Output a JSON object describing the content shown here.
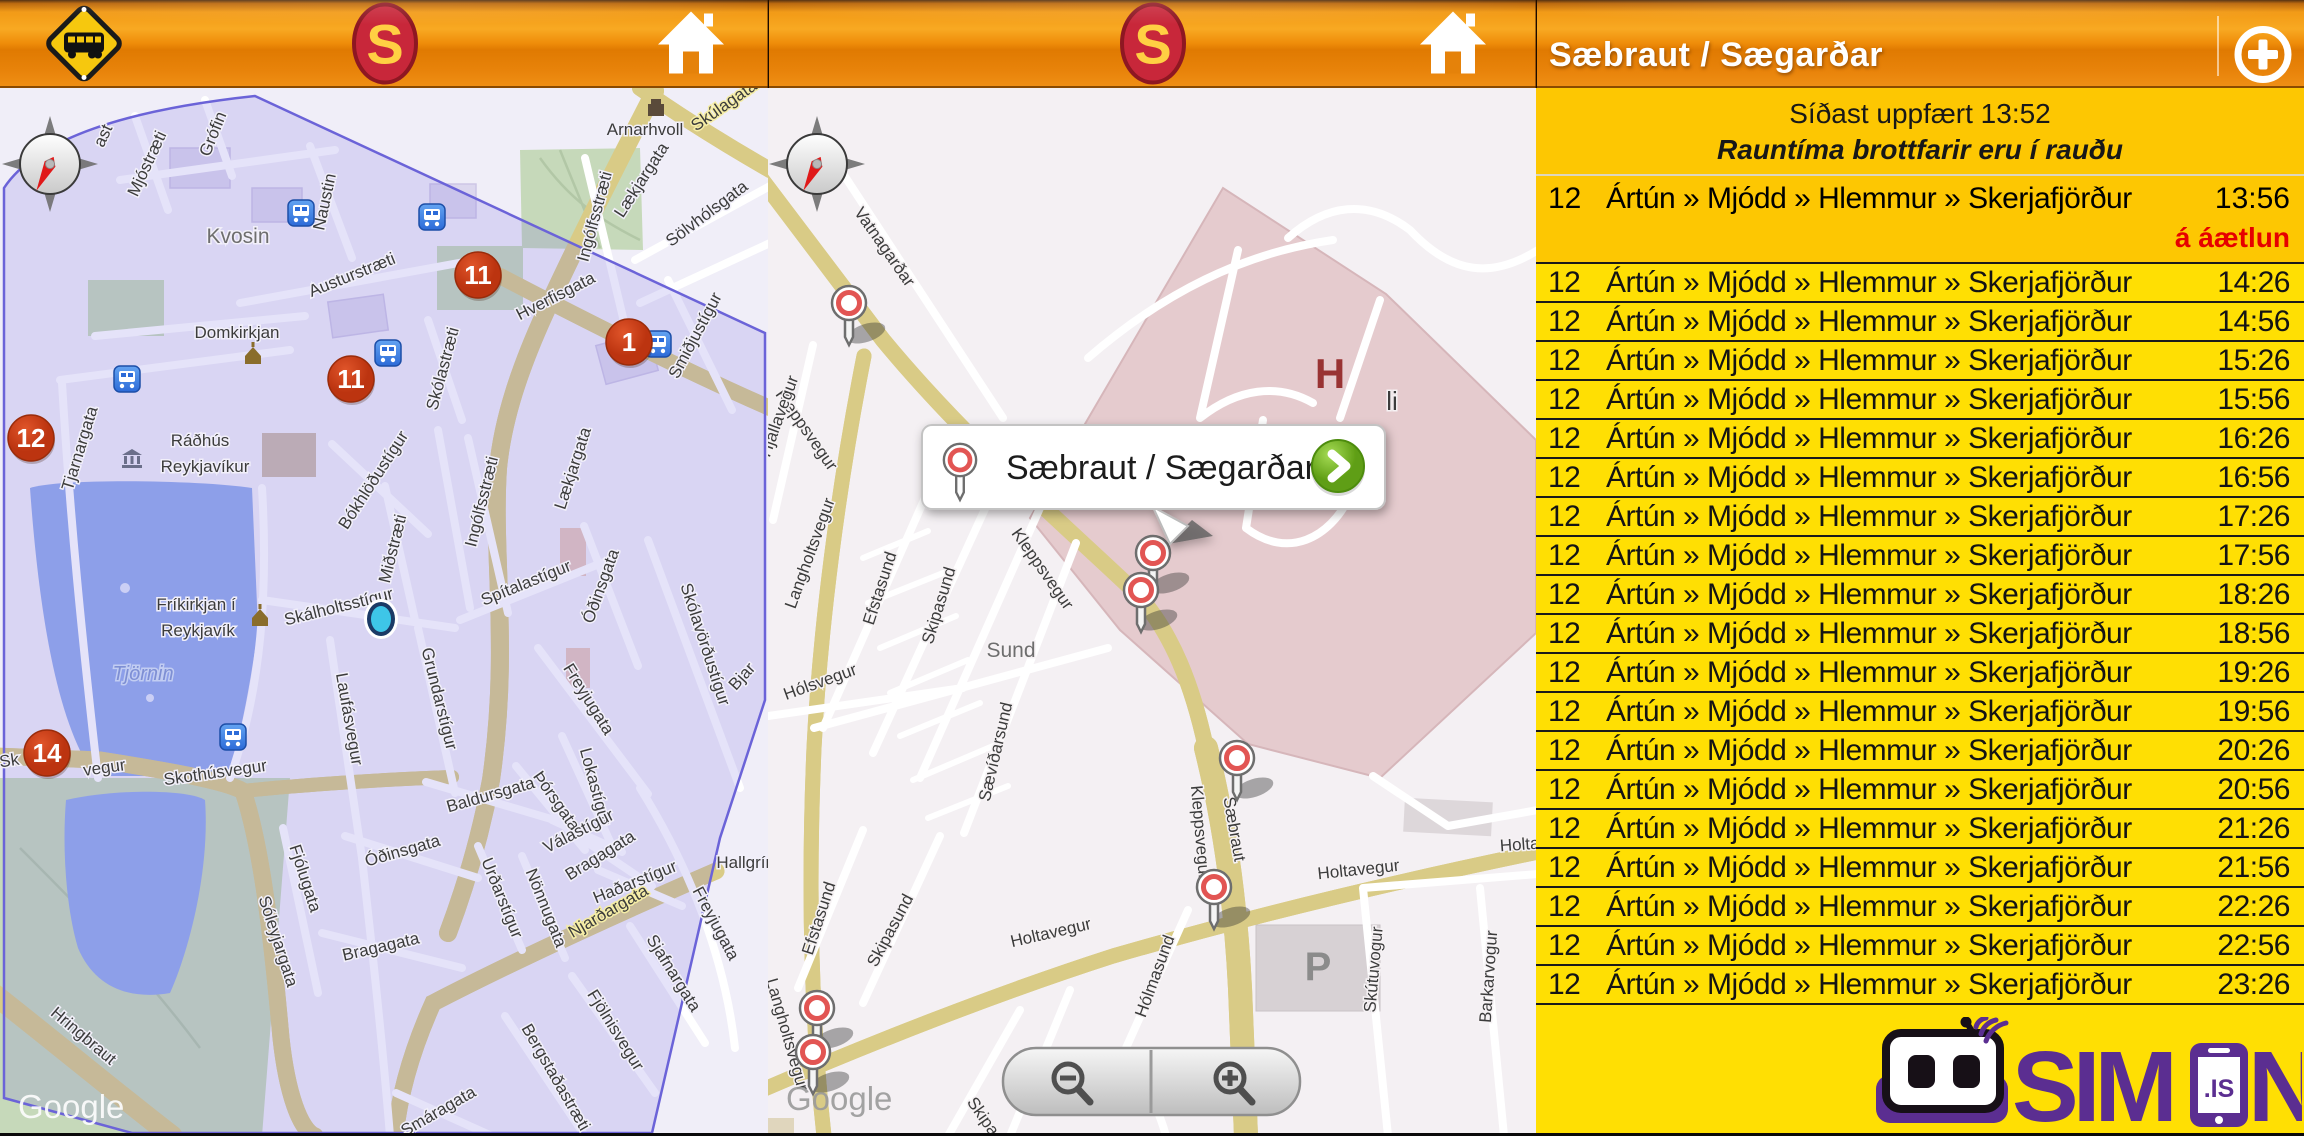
{
  "header": {
    "s_letter": "S",
    "icons": [
      "bus-stop-sign",
      "straeto-s-logo",
      "home",
      "add-stop-plus"
    ]
  },
  "right_panel": {
    "title": "Sæbraut / Sægarðar",
    "schedule": {
      "updated": "Síðast uppfært 13:52",
      "note": "Rauntíma brottfarir eru í rauðu",
      "first": {
        "route": "12",
        "destination": "Ártún » Mjódd » Hlemmur » Skerjafjörður",
        "time": "13:56",
        "status": "á áætlun"
      },
      "route": "12",
      "destination": "Ártún » Mjódd » Hlemmur » Skerjafjörður",
      "times": [
        "14:26",
        "14:56",
        "15:26",
        "15:56",
        "16:26",
        "16:56",
        "17:26",
        "17:56",
        "18:26",
        "18:56",
        "19:26",
        "19:56",
        "20:26",
        "20:56",
        "21:26",
        "21:56",
        "22:26",
        "22:56",
        "23:26"
      ]
    },
    "logo": {
      "sim": "SIM",
      "n": "N",
      "is": ".IS"
    },
    "colors": {
      "top_block": "#fdc702",
      "rows": "#ffdf03",
      "realtime_red": "#e60000",
      "logo_purple": "#5b2e91"
    }
  },
  "popup": {
    "label": "Sæbraut / Sægarðar"
  },
  "left_map": {
    "google": "Google",
    "labels": [
      [
        "ast",
        108,
        50,
        -65
      ],
      [
        "Mjóstræti",
        152,
        78,
        -65
      ],
      [
        "Grófin",
        218,
        48,
        -68
      ],
      [
        "Naustin",
        330,
        115,
        -78
      ],
      [
        "Kvosin",
        238,
        155,
        0,
        "district"
      ],
      [
        "Austurstræti",
        354,
        192,
        -22
      ],
      [
        "Lækjargata",
        646,
        95,
        -57
      ],
      [
        "Skúlagata",
        727,
        22,
        -35,
        "yellow"
      ],
      [
        "Arnarhvoll",
        645,
        47,
        0
      ],
      [
        "Sölvhólsgata",
        710,
        130,
        -37
      ],
      [
        "Ingólfsstræti",
        600,
        130,
        -75
      ],
      [
        "Hverfisgata",
        558,
        213,
        -27
      ],
      [
        "Smiðjustígur",
        700,
        250,
        -62
      ],
      [
        "Skólastræti",
        448,
        282,
        -75
      ],
      [
        "Domkirkjan",
        237,
        250,
        0
      ],
      [
        "Tjarnargata",
        85,
        362,
        -73
      ],
      [
        "Ráðhús",
        200,
        358,
        0
      ],
      [
        "Reykjavíkur",
        205,
        384,
        0
      ],
      [
        "Lækjargata",
        578,
        382,
        -72
      ],
      [
        "Bókhlöðustígur",
        378,
        395,
        -57
      ],
      [
        "Miðstræti",
        398,
        462,
        -76
      ],
      [
        "Ingólfsstræti",
        487,
        415,
        -76
      ],
      [
        "Spítalastígur",
        528,
        500,
        -22
      ],
      [
        "Óðinsgata",
        606,
        500,
        -70
      ],
      [
        "Skólavörðustígur",
        700,
        558,
        72
      ],
      [
        "Fríkirkjan í",
        196,
        522,
        0
      ],
      [
        "Reykjavík",
        198,
        548,
        0
      ],
      [
        "Tjörnin",
        143,
        592,
        0,
        "water"
      ],
      [
        "Skálholtsstígur",
        340,
        524,
        -14
      ],
      [
        "Laufásvegur",
        344,
        632,
        80
      ],
      [
        "Grundarstígur",
        434,
        612,
        76
      ],
      [
        "Freyjugata",
        584,
        614,
        58
      ],
      [
        "Bjar",
        746,
        592,
        -48
      ],
      [
        "Skothúsvegur",
        216,
        690,
        -8
      ],
      [
        "Sk",
        10,
        678,
        -8
      ],
      [
        "vegur",
        105,
        685,
        -8
      ],
      [
        "Baldursgata",
        492,
        712,
        -16
      ],
      [
        "Þórsgata",
        552,
        716,
        55
      ],
      [
        "Lokastígur",
        590,
        700,
        75
      ],
      [
        "Fjólugata",
        300,
        792,
        72
      ],
      [
        "Sóleyjargata",
        273,
        855,
        72
      ],
      [
        "Óðinsgata",
        404,
        768,
        -16
      ],
      [
        "Bragagata",
        382,
        864,
        -13
      ],
      [
        "Urðarstígur",
        497,
        812,
        68
      ],
      [
        "Nönnugata",
        541,
        822,
        68
      ],
      [
        "Válastígur",
        581,
        748,
        -27
      ],
      [
        "Bragagata",
        603,
        772,
        -32
      ],
      [
        "Haðarstígur",
        637,
        799,
        -22
      ],
      [
        "Njarðargata",
        611,
        828,
        -30,
        "yellow"
      ],
      [
        "Freyjugata",
        711,
        838,
        62
      ],
      [
        "Sjafnargata",
        669,
        888,
        58
      ],
      [
        "Fjölnisvegur",
        611,
        945,
        58
      ],
      [
        "Bergstaðastræti",
        551,
        992,
        60
      ],
      [
        "Smáragata",
        441,
        1028,
        -30
      ],
      [
        "Hringbraut",
        80,
        952,
        40
      ],
      [
        "Hallgrím",
        748,
        780,
        0
      ]
    ],
    "markers": [
      {
        "n": "11",
        "x": 478,
        "y": 187
      },
      {
        "n": "1",
        "x": 629,
        "y": 254
      },
      {
        "n": "11",
        "x": 351,
        "y": 291
      },
      {
        "n": "12",
        "x": 31,
        "y": 350
      },
      {
        "n": "14",
        "x": 47,
        "y": 665
      }
    ],
    "bus_stops": [
      [
        301,
        125
      ],
      [
        432,
        129
      ],
      [
        388,
        265
      ],
      [
        127,
        291
      ],
      [
        658,
        256
      ],
      [
        233,
        649
      ]
    ],
    "landmarks": [
      {
        "type": "church",
        "x": 253,
        "y": 268
      },
      {
        "type": "church",
        "x": 260,
        "y": 530
      },
      {
        "type": "museum",
        "x": 132,
        "y": 372
      },
      {
        "type": "building",
        "x": 656,
        "y": 20
      }
    ],
    "location_dot": [
      381,
      531
    ],
    "compass": [
      50,
      76
    ]
  },
  "middle_map": {
    "google": "Google",
    "hospital_h": "H",
    "parking_p": "P",
    "cut_label": "li",
    "labels": [
      [
        "Vatnagarðar",
        112,
        162,
        55
      ],
      [
        "Kleppsvegur",
        34,
        345,
        55
      ],
      [
        "Kleppsvegur",
        270,
        484,
        55
      ],
      [
        "Langholtsvegur",
        47,
        467,
        -70,
        "yellow"
      ],
      [
        "Langholtsvegur",
        14,
        948,
        74,
        "yellow"
      ],
      [
        "Hjallavegur",
        16,
        330,
        -70
      ],
      [
        "Efstasund",
        117,
        502,
        -72
      ],
      [
        "Skipasund",
        176,
        519,
        -73
      ],
      [
        "Sund",
        243,
        569,
        0,
        "district"
      ],
      [
        "Hólsvegur",
        54,
        599,
        -20
      ],
      [
        "Sævíðarsund",
        233,
        665,
        -77
      ],
      [
        "Efstasund",
        56,
        832,
        -72
      ],
      [
        "Skipasund",
        127,
        845,
        -62
      ],
      [
        "Holtavegur",
        284,
        850,
        -13,
        "yellow"
      ],
      [
        "Holtavegur",
        591,
        787,
        -6,
        "yellow"
      ],
      [
        "Holta",
        752,
        762,
        -4,
        "yellow"
      ],
      [
        "Hólmasund",
        392,
        890,
        -70
      ],
      [
        "Skútuvogur",
        611,
        882,
        -85
      ],
      [
        "Barkarvogur",
        726,
        889,
        -86
      ],
      [
        "Sævíða",
        270,
        990,
        70
      ],
      [
        "Skipas",
        213,
        1035,
        55
      ],
      [
        "Sæbraut",
        461,
        742,
        80,
        "yellow"
      ],
      [
        "Kleppsvegur",
        427,
        745,
        85
      ]
    ],
    "pins": [
      [
        81,
        215
      ],
      [
        385,
        465
      ],
      [
        373,
        502
      ],
      [
        469,
        670
      ],
      [
        446,
        799
      ],
      [
        49,
        920
      ],
      [
        45,
        964
      ]
    ],
    "compass": [
      49,
      76
    ]
  }
}
